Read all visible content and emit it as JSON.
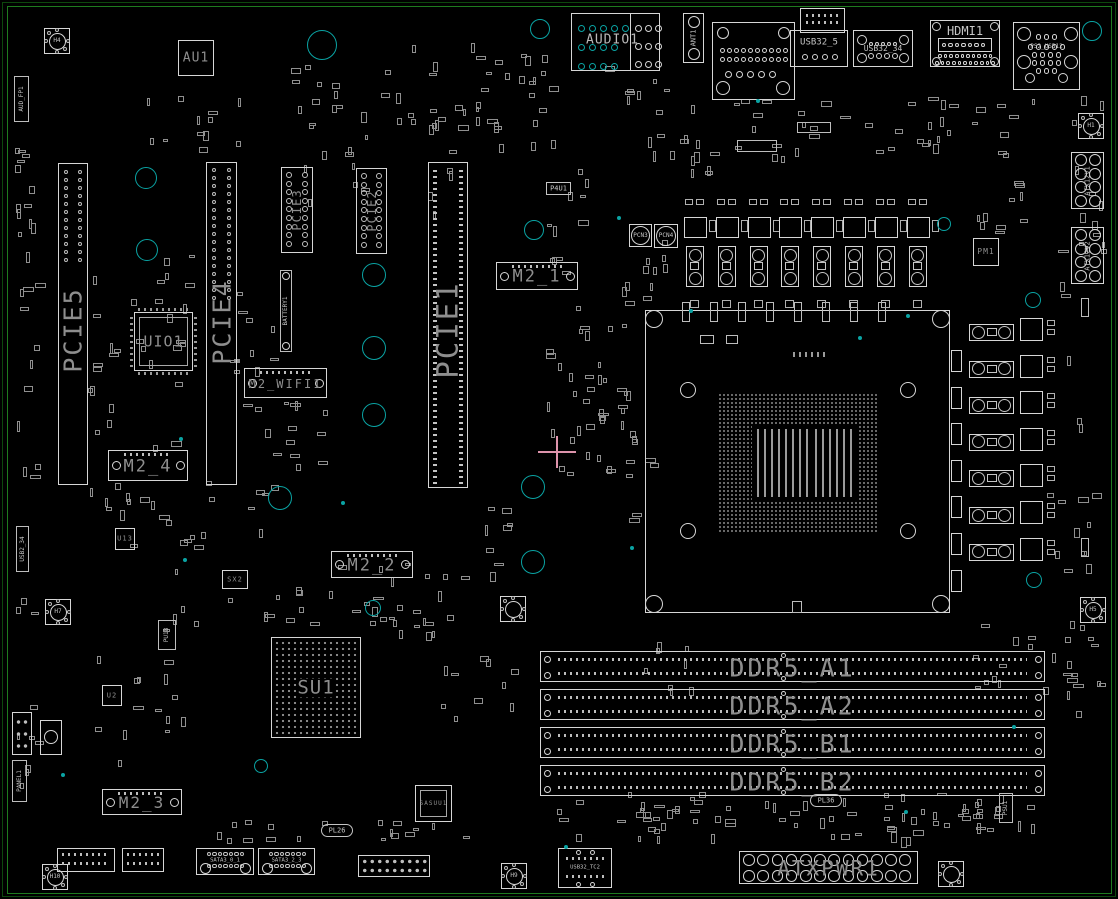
{
  "colors": {
    "bg": "#000000",
    "outline": "#d6d6d6",
    "outline_dim": "#9b9b9b",
    "label_gray": "#8e8e8e",
    "label_light": "#c6c6c6",
    "teal": "#0aa3a3",
    "green_frame": "#1e7a1e",
    "green_frame_dim": "#0d470d",
    "pink": "#dd93ab"
  },
  "crosshair": {
    "x": 557,
    "y": 452
  },
  "rear_io": [
    {
      "label": "AUDIO1",
      "type": "audio",
      "x": 571,
      "y": 13,
      "w": 89,
      "h": 58
    },
    {
      "label": "ANT1",
      "type": "vconn",
      "x": 683,
      "y": 13,
      "w": 21,
      "h": 50
    },
    {
      "label": "",
      "type": "lan",
      "x": 712,
      "y": 22,
      "w": 83,
      "h": 78
    },
    {
      "label": "USB32_5",
      "type": "usb",
      "x": 790,
      "y": 30,
      "w": 58,
      "h": 37
    },
    {
      "label": "USB32_34",
      "type": "usb4c",
      "x": 853,
      "y": 30,
      "w": 60,
      "h": 37
    },
    {
      "label": "HDMI1",
      "type": "hdmi",
      "x": 930,
      "y": 20,
      "w": 70,
      "h": 47
    },
    {
      "label": "PS2_USB12",
      "type": "ps2",
      "x": 1013,
      "y": 22,
      "w": 67,
      "h": 68
    }
  ],
  "pcie_slots": [
    {
      "label": "PCIE5",
      "x": 58,
      "y": 163,
      "w": 30,
      "h": 322,
      "label_cy": 330,
      "fs": 25,
      "pad_rows": 12,
      "pad_y0": 172,
      "pad_step": 8
    },
    {
      "label": "PCIE4",
      "x": 206,
      "y": 162,
      "w": 31,
      "h": 323,
      "label_cy": 322,
      "fs": 25,
      "pad_rows": 17,
      "pad_y0": 170,
      "pad_step": 8
    },
    {
      "label": "PCIE1",
      "x": 428,
      "y": 162,
      "w": 40,
      "h": 326,
      "label_cy": 330,
      "fs": 29,
      "ticks": true
    }
  ],
  "pcie_headers": [
    {
      "label": "PCIE3",
      "x": 281,
      "y": 167,
      "w": 32,
      "h": 86
    },
    {
      "label": "PCIE2",
      "x": 356,
      "y": 168,
      "w": 31,
      "h": 86
    }
  ],
  "m2_slots": [
    {
      "label": "M2_1",
      "x": 496,
      "y": 262,
      "w": 82,
      "h": 28,
      "fs": 17
    },
    {
      "label": "M2_2",
      "x": 331,
      "y": 551,
      "w": 82,
      "h": 27,
      "fs": 17
    },
    {
      "label": "M2_3",
      "x": 102,
      "y": 789,
      "w": 80,
      "h": 26,
      "fs": 16
    },
    {
      "label": "M2_4",
      "x": 108,
      "y": 450,
      "w": 80,
      "h": 31,
      "fs": 17
    },
    {
      "label": "M2_WIFI1",
      "x": 244,
      "y": 368,
      "w": 83,
      "h": 30,
      "fs": 12
    }
  ],
  "ddr": {
    "x": 540,
    "w": 505,
    "h": 31,
    "fs": 25,
    "items": [
      {
        "label": "DDR5_A1",
        "y": 651
      },
      {
        "label": "DDR5_A2",
        "y": 689
      },
      {
        "label": "DDR5_B1",
        "y": 727
      },
      {
        "label": "DDR5_B2",
        "y": 765
      }
    ]
  },
  "cpu_socket": {
    "x": 645,
    "y": 310,
    "w": 305,
    "h": 303
  },
  "chips": [
    {
      "label": "AU1",
      "x": 178,
      "y": 40,
      "w": 36,
      "h": 36,
      "fs": 13,
      "style": "plain"
    },
    {
      "label": "UIO1",
      "x": 134,
      "y": 312,
      "w": 59,
      "h": 59,
      "fs": 15,
      "style": "inner"
    },
    {
      "label": "SU1",
      "x": 271,
      "y": 637,
      "w": 90,
      "h": 101,
      "fs": 19,
      "style": "bga"
    },
    {
      "label": "PM1",
      "x": 973,
      "y": 238,
      "w": 26,
      "h": 28,
      "fs": 8,
      "style": "plain"
    },
    {
      "label": "U13",
      "x": 115,
      "y": 528,
      "w": 20,
      "h": 22,
      "fs": 7,
      "style": "plain"
    },
    {
      "label": "U2",
      "x": 102,
      "y": 685,
      "w": 20,
      "h": 21,
      "fs": 7,
      "style": "plain"
    },
    {
      "label": "SX2",
      "x": 222,
      "y": 570,
      "w": 26,
      "h": 19,
      "fs": 7,
      "style": "plain"
    },
    {
      "label": "SASUU1",
      "x": 415,
      "y": 785,
      "w": 37,
      "h": 37,
      "fs": 6,
      "style": "inner"
    }
  ],
  "power": {
    "atxpwr": {
      "label": "ATXPWR1",
      "x": 739,
      "y": 851,
      "w": 179,
      "h": 33,
      "fs": 21
    },
    "atx12v": [
      {
        "label": "ATX12V1",
        "x": 1071,
        "y": 152,
        "w": 33,
        "h": 57
      },
      {
        "label": "ATX12V2",
        "x": 1071,
        "y": 227,
        "w": 33,
        "h": 57
      }
    ],
    "pcn": [
      {
        "label": "PCN3",
        "x": 629,
        "y": 224,
        "s": 23
      },
      {
        "label": "PCN4",
        "x": 654,
        "y": 224,
        "s": 24
      }
    ],
    "vrm_top": {
      "count": 8,
      "x0": 684,
      "pitch": 31.8
    },
    "vrm_right": {
      "count": 7,
      "y0": 318,
      "pitch": 36.6
    }
  },
  "holes": [
    {
      "label": "H4",
      "cx": 57,
      "cy": 41
    },
    {
      "label": "H1",
      "cx": 1091,
      "cy": 126
    },
    {
      "label": "H5",
      "cx": 1093,
      "cy": 610
    },
    {
      "label": "H7",
      "cx": 58,
      "cy": 612
    },
    {
      "label": "",
      "cx": 513,
      "cy": 609
    },
    {
      "label": "H9",
      "cx": 514,
      "cy": 876
    },
    {
      "label": "H10",
      "cx": 55,
      "cy": 877
    },
    {
      "label": "",
      "cx": 951,
      "cy": 874
    }
  ],
  "vlabels": [
    {
      "label": "BATTERY1",
      "x": 280,
      "y": 270,
      "w": 12,
      "h": 82,
      "fs": 6,
      "ends": true
    },
    {
      "label": "PANEL1",
      "x": 12,
      "y": 760,
      "w": 15,
      "h": 42,
      "fs": 6
    },
    {
      "label": "AUD_FP1",
      "x": 14,
      "y": 76,
      "w": 15,
      "h": 46,
      "fs": 6
    },
    {
      "label": "USB2_34",
      "x": 16,
      "y": 526,
      "w": 13,
      "h": 46,
      "fs": 6
    },
    {
      "label": "PU18",
      "x": 158,
      "y": 620,
      "w": 18,
      "h": 30,
      "fs": 6
    },
    {
      "label": "PSU1",
      "x": 999,
      "y": 793,
      "w": 14,
      "h": 30,
      "fs": 6
    }
  ],
  "tags": [
    {
      "label": "PL36",
      "x": 810,
      "y": 794,
      "w": 32,
      "h": 13,
      "fs": 7,
      "round": true
    },
    {
      "label": "PL26",
      "x": 321,
      "y": 824,
      "w": 32,
      "h": 13,
      "fs": 7,
      "round": true
    },
    {
      "label": "P4U1",
      "x": 546,
      "y": 182,
      "w": 25,
      "h": 13,
      "fs": 7,
      "round": false
    }
  ],
  "sata": [
    {
      "label": "SATA3_0_1",
      "x": 196,
      "y": 848,
      "w": 58,
      "h": 27
    },
    {
      "label": "SATA3_2_3",
      "x": 258,
      "y": 848,
      "w": 57,
      "h": 27
    }
  ],
  "usb_tc": {
    "label": "USB32_TC2",
    "x": 558,
    "y": 848,
    "w": 54,
    "h": 40
  },
  "teal_rings": [
    [
      540,
      29,
      10
    ],
    [
      1092,
      31,
      10
    ],
    [
      322,
      45,
      15
    ],
    [
      146,
      178,
      11
    ],
    [
      147,
      250,
      11
    ],
    [
      374,
      275,
      12
    ],
    [
      374,
      348,
      12
    ],
    [
      374,
      415,
      12
    ],
    [
      534,
      230,
      10
    ],
    [
      533,
      487,
      12
    ],
    [
      533,
      562,
      12
    ],
    [
      280,
      498,
      12
    ],
    [
      373,
      608,
      8
    ],
    [
      1033,
      300,
      8
    ],
    [
      1034,
      580,
      8
    ],
    [
      261,
      766,
      7
    ],
    [
      944,
      224,
      7
    ]
  ],
  "teal_dots": [
    [
      181,
      439
    ],
    [
      632,
      548
    ],
    [
      691,
      311
    ],
    [
      860,
      338
    ],
    [
      908,
      316
    ],
    [
      758,
      101
    ],
    [
      343,
      503
    ],
    [
      63,
      775
    ],
    [
      906,
      812
    ],
    [
      619,
      218
    ],
    [
      1014,
      727
    ],
    [
      566,
      847
    ],
    [
      185,
      560
    ]
  ]
}
